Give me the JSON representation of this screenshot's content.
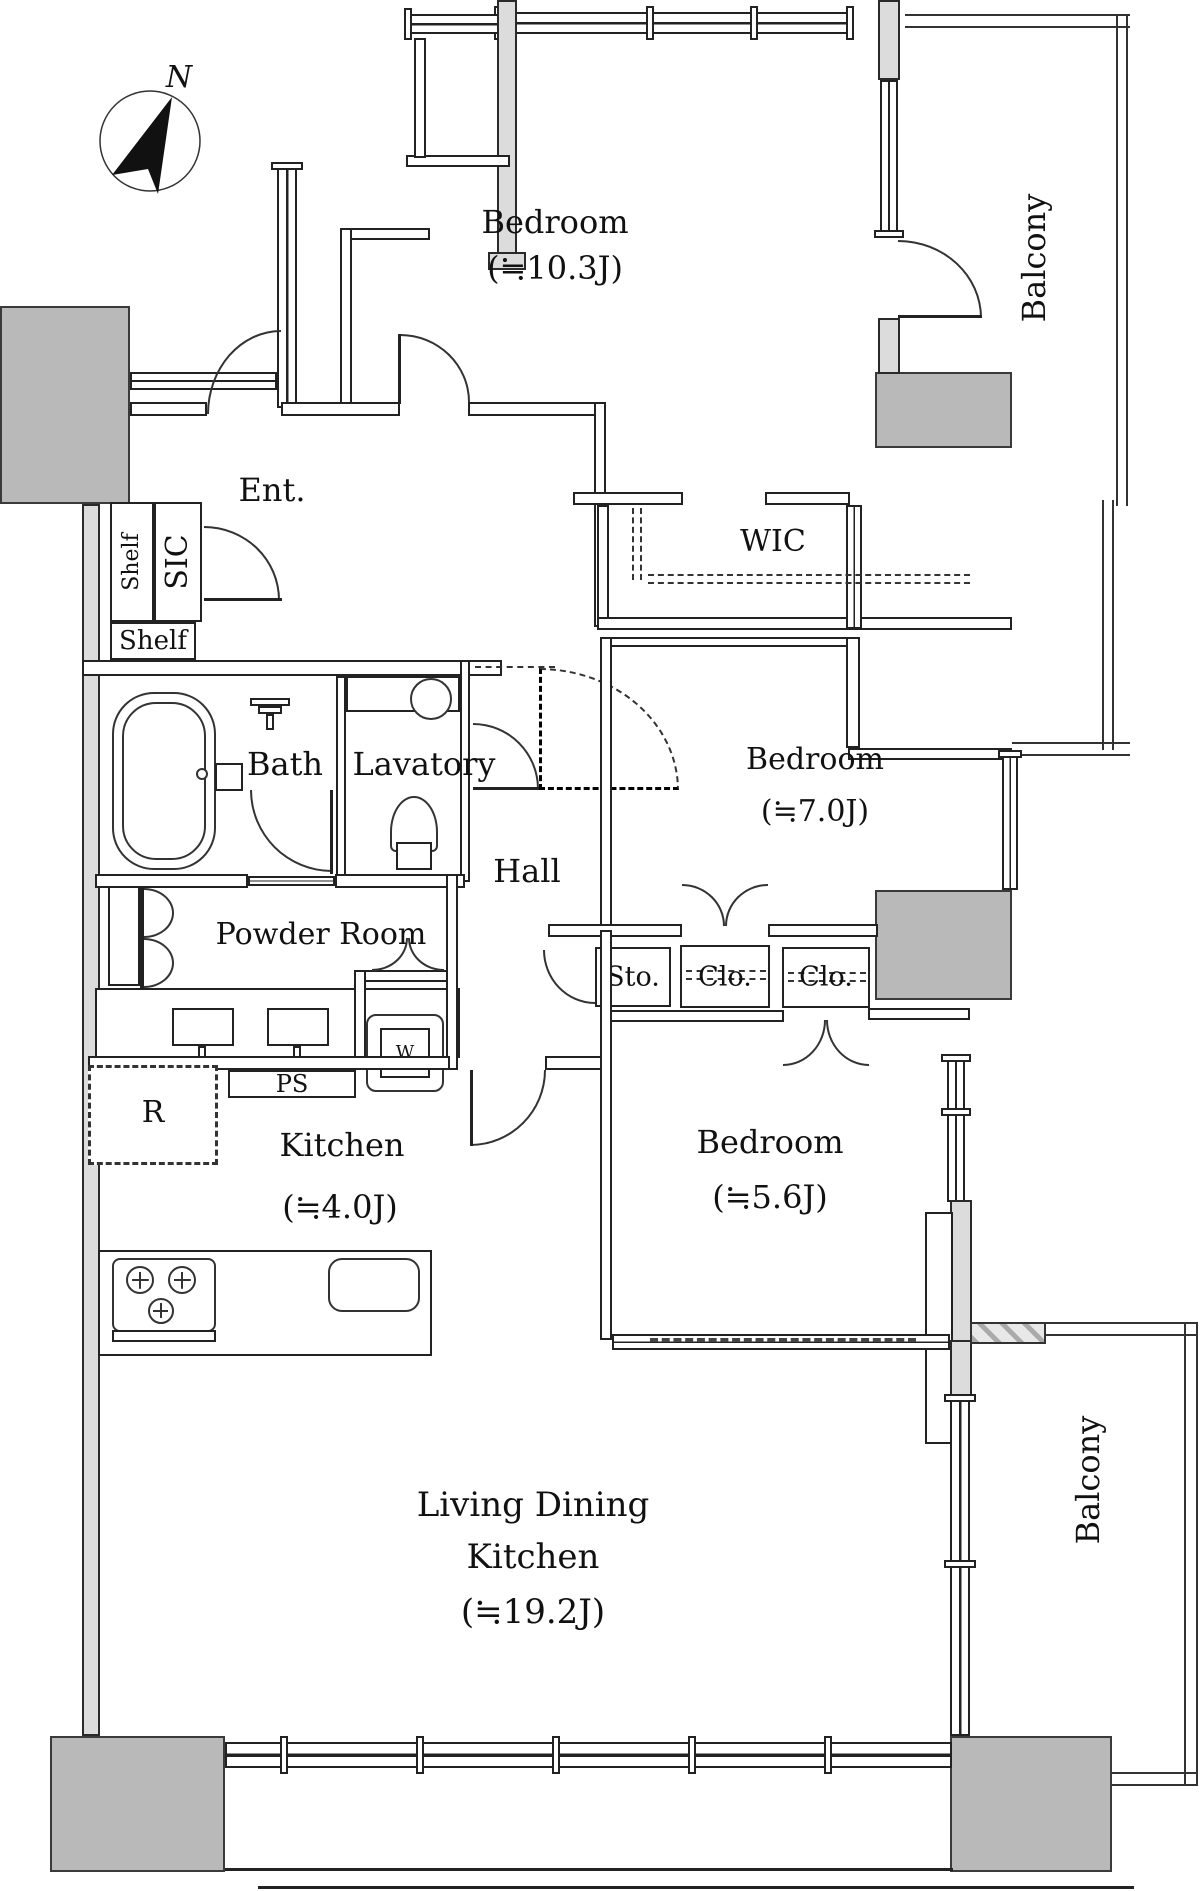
{
  "compass": {
    "north": "N"
  },
  "rooms": {
    "bedroom1": {
      "name": "Bedroom",
      "size": "(≒10.3J)"
    },
    "bedroom2": {
      "name": "Bedroom",
      "size": "(≒7.0J)"
    },
    "bedroom3": {
      "name": "Bedroom",
      "size": "(≒5.6J)"
    },
    "kitchen": {
      "name": "Kitchen",
      "size": "(≒4.0J)"
    },
    "ldk": {
      "line1": "Living Dining",
      "line2": "Kitchen",
      "size": "(≒19.2J)"
    },
    "entrance": {
      "name": "Ent."
    },
    "hall": {
      "name": "Hall"
    },
    "bath": {
      "name": "Bath"
    },
    "lavatory": {
      "name": "Lavatory"
    },
    "powder": {
      "name": "Powder Room"
    }
  },
  "storage": {
    "wic": {
      "name": "WIC"
    },
    "sic": {
      "name": "SIC"
    },
    "shelf_v": {
      "name": "Shelf"
    },
    "shelf_h": {
      "name": "Shelf"
    },
    "sto": {
      "name": "Sto."
    },
    "clo1": {
      "name": "Clo."
    },
    "clo2": {
      "name": "Clo."
    }
  },
  "fixtures": {
    "ps": "PS",
    "refrigerator": "R",
    "washer": "W"
  },
  "balconies": {
    "top": "Balcony",
    "bottom": "Balcony"
  },
  "colors": {
    "wall_line": "#222222",
    "pillar_gray": "#b9b9b9",
    "wall_gray": "#dcdcdc",
    "background": "#ffffff"
  }
}
